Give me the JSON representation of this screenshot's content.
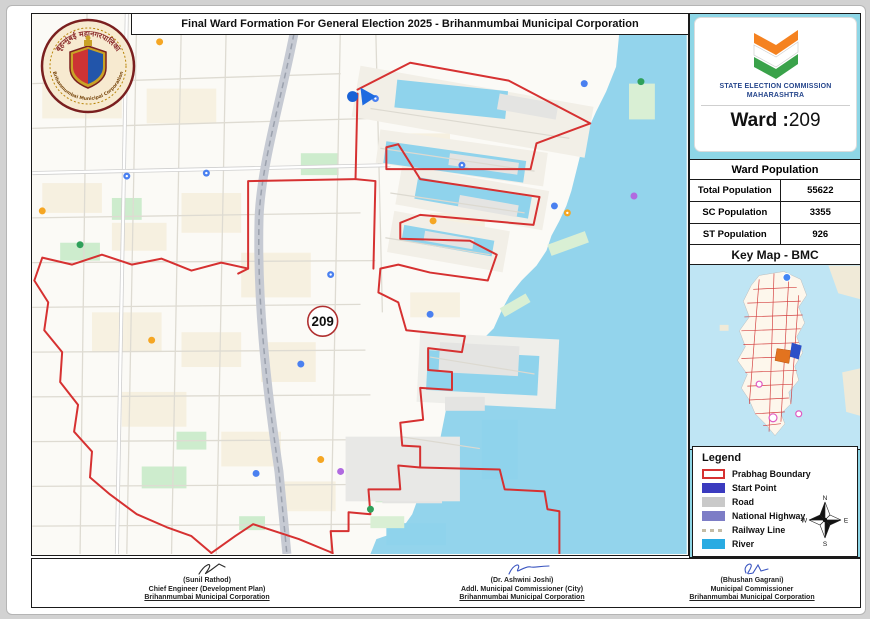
{
  "title": "Final Ward Formation For General Election 2025 - Brihanmumbai Municipal Corporation",
  "bmc_logo": {
    "arc_top": "बृहन्मुंबई महानगरपालिका",
    "arc_bottom": "Brihanmumbai Municipal Corporation"
  },
  "sec": {
    "line1": "STATE ELECTION COMMISSION",
    "line2": "MAHARASHTRA",
    "ward_label": "Ward :",
    "ward_number": "209"
  },
  "population": {
    "header": "Ward Population",
    "rows": [
      {
        "label": "Total Population",
        "value": "55622"
      },
      {
        "label": "SC Population",
        "value": "3355"
      },
      {
        "label": "ST Population",
        "value": "926"
      }
    ]
  },
  "keymap": {
    "header": "Key Map - BMC"
  },
  "legend": {
    "title": "Legend",
    "items": [
      {
        "label": "Prabhag Boundary",
        "color": "#d63131",
        "type": "outline"
      },
      {
        "label": "Start Point",
        "color": "#3b3bbf",
        "type": "fill"
      },
      {
        "label": "Road",
        "color": "#c9c9c9",
        "type": "fill"
      },
      {
        "label": "National Highway",
        "color": "#7d7dc6",
        "type": "fill"
      },
      {
        "label": "Railway Line",
        "color": "#c4bca6",
        "type": "dashes"
      },
      {
        "label": "River",
        "color": "#29abe2",
        "type": "fill"
      }
    ],
    "compass": {
      "n": "N",
      "s": "S",
      "e": "E",
      "w": "W"
    }
  },
  "map": {
    "ward_badge": "209",
    "boundary_color": "#d63131",
    "sea_color": "#93d4ec",
    "start_point_color": "#1962d6"
  },
  "signatures": [
    {
      "name": "(Sunil Rathod)",
      "role": "Chief Engineer (Development Plan)",
      "org": "Brihanmumbai Municipal Corporation"
    },
    {
      "name": "(Dr. Ashwini Joshi)",
      "role": "Addl. Municipal Commissioner (City)",
      "org": "Brihanmumbai Municipal Corporation"
    },
    {
      "name": "(Bhushan Gagrani)",
      "role": "Municipal Commissioner",
      "org": "Brihanmumbai Municipal Corporation"
    }
  ]
}
